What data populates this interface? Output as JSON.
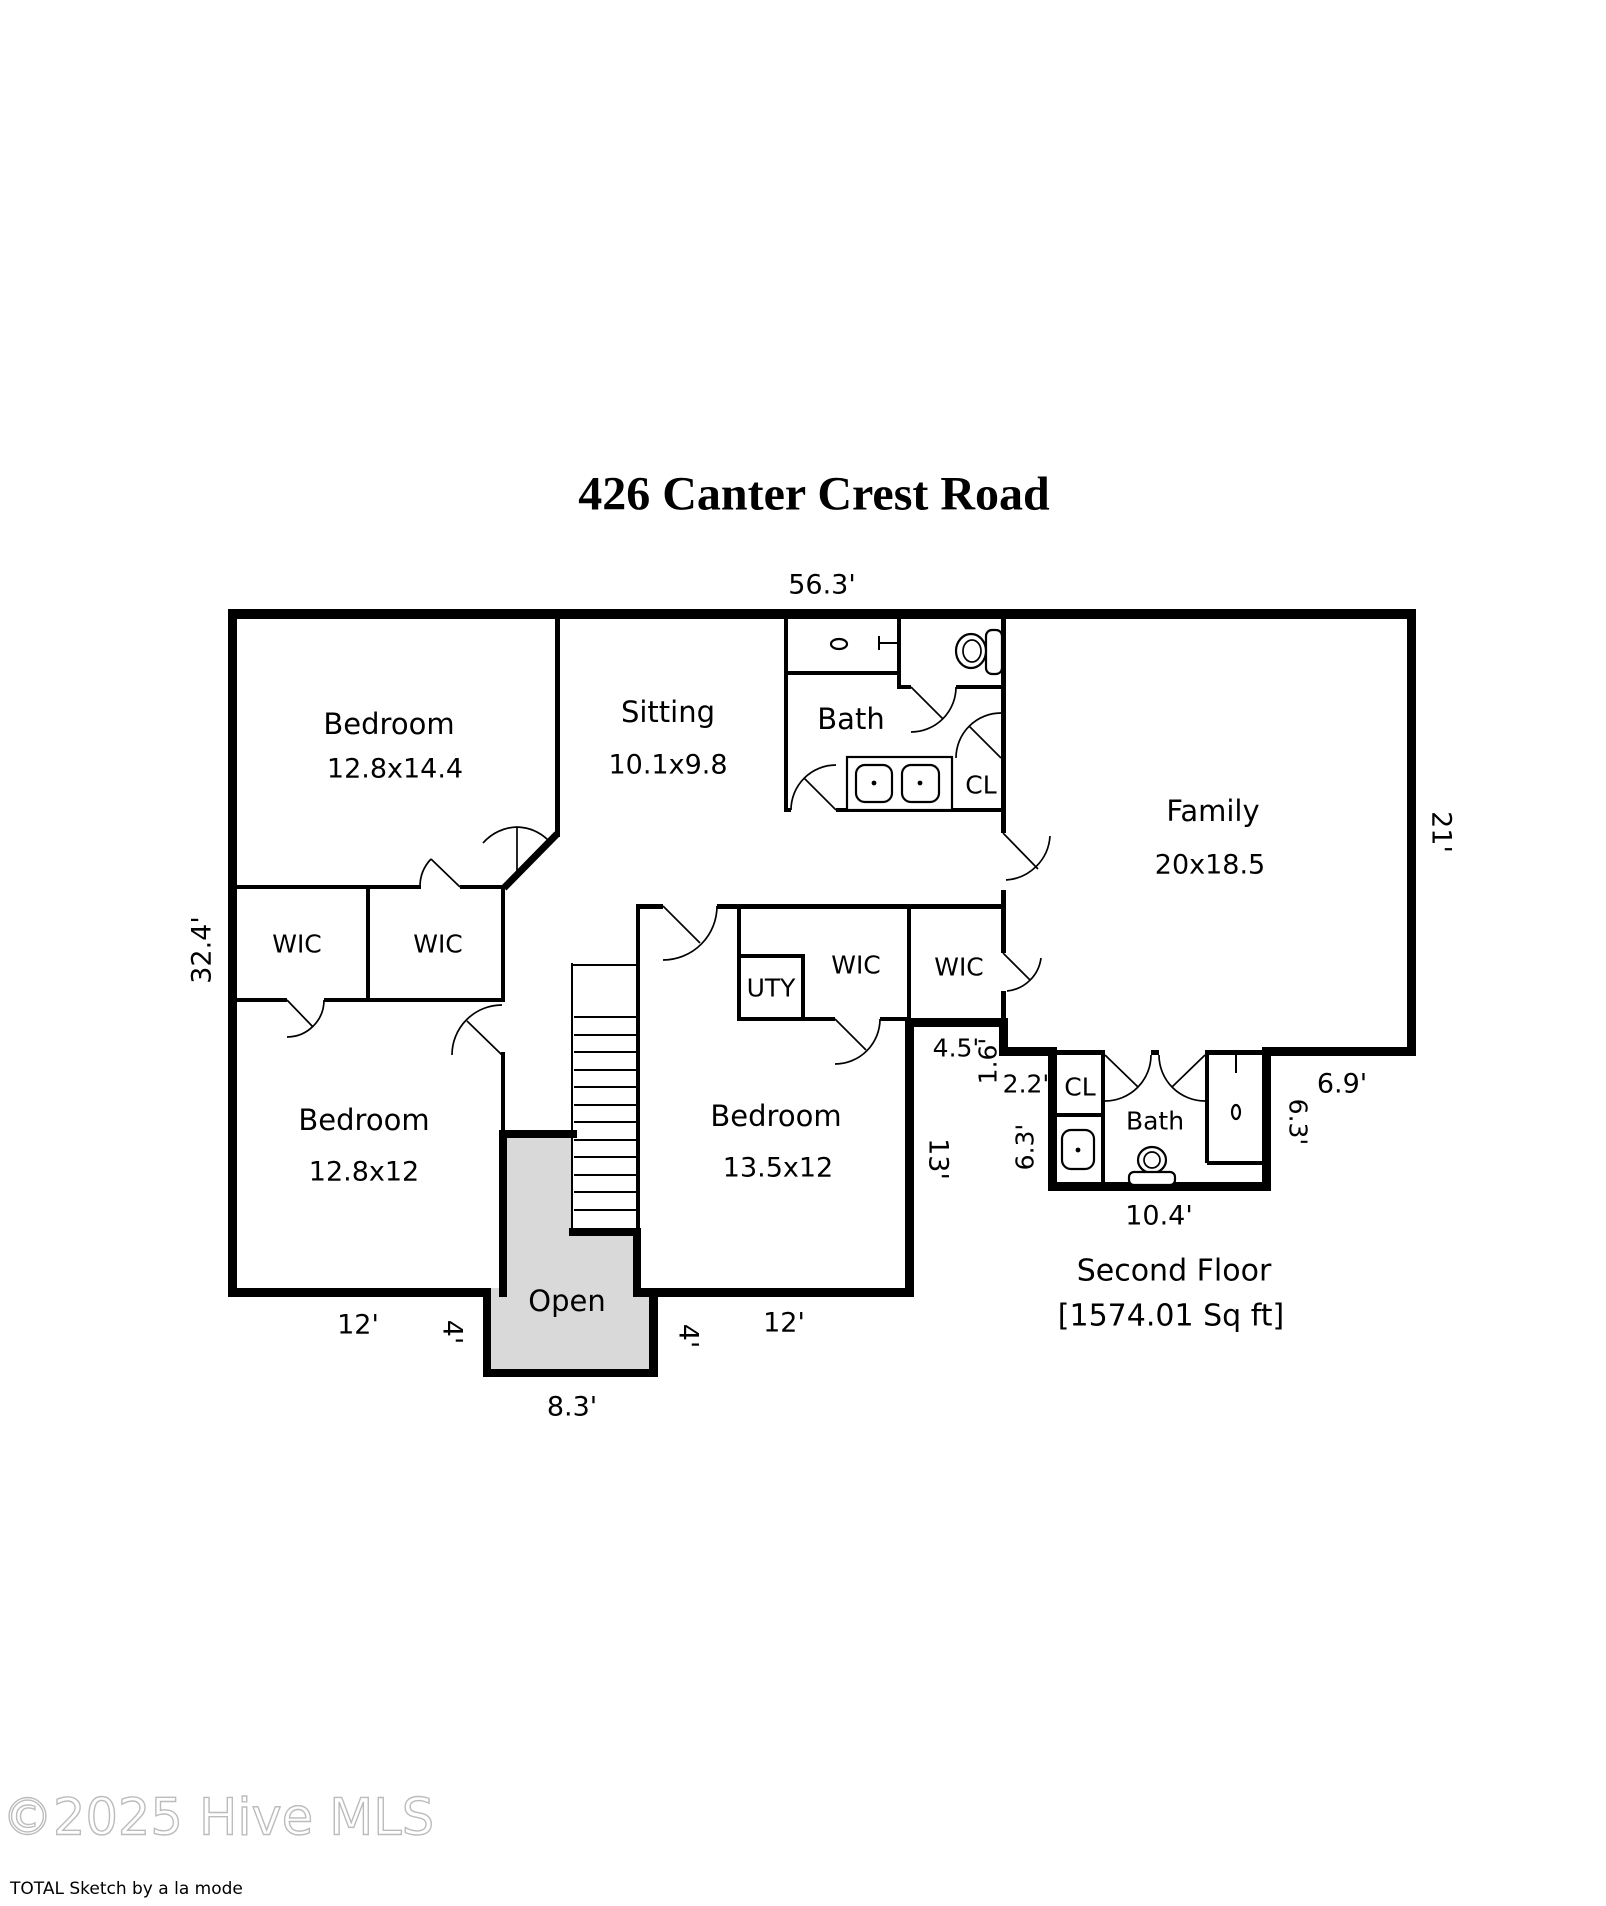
{
  "title": "426 Canter Crest Road",
  "rooms": {
    "bedroom1": {
      "name": "Bedroom",
      "dims": "12.8x14.4"
    },
    "sitting": {
      "name": "Sitting",
      "dims": "10.1x9.8"
    },
    "bath_upper": {
      "name": "Bath"
    },
    "cl_upper": {
      "name": "CL"
    },
    "family": {
      "name": "Family",
      "dims": "20x18.5"
    },
    "wic_left1": {
      "name": "WIC"
    },
    "wic_left2": {
      "name": "WIC"
    },
    "uty": {
      "name": "UTY"
    },
    "wic_mid": {
      "name": "WIC"
    },
    "wic_right": {
      "name": "WIC"
    },
    "bedroom2": {
      "name": "Bedroom",
      "dims": "12.8x12"
    },
    "bedroom3": {
      "name": "Bedroom",
      "dims": "13.5x12"
    },
    "open": {
      "name": "Open"
    },
    "cl_lower": {
      "name": "CL"
    },
    "bath_lower": {
      "name": "Bath"
    }
  },
  "dims": {
    "top": "56.3'",
    "right": "21'",
    "left": "32.4'",
    "d45": "4.5'",
    "d16": "1.6'",
    "d22": "2.2'",
    "d63_left": "6.3'",
    "d13": "13'",
    "d69": "6.9'",
    "d63_right": "6.3'",
    "d104": "10.4'",
    "d12_left": "12'",
    "d4_left": "4'",
    "d4_right": "4'",
    "d12_right": "12'",
    "d83": "8.3'"
  },
  "floor": {
    "name": "Second Floor",
    "area": "[1574.01 Sq ft]"
  },
  "footer": {
    "watermark": "©2025 Hive MLS",
    "credit": "TOTAL Sketch by a la mode"
  }
}
